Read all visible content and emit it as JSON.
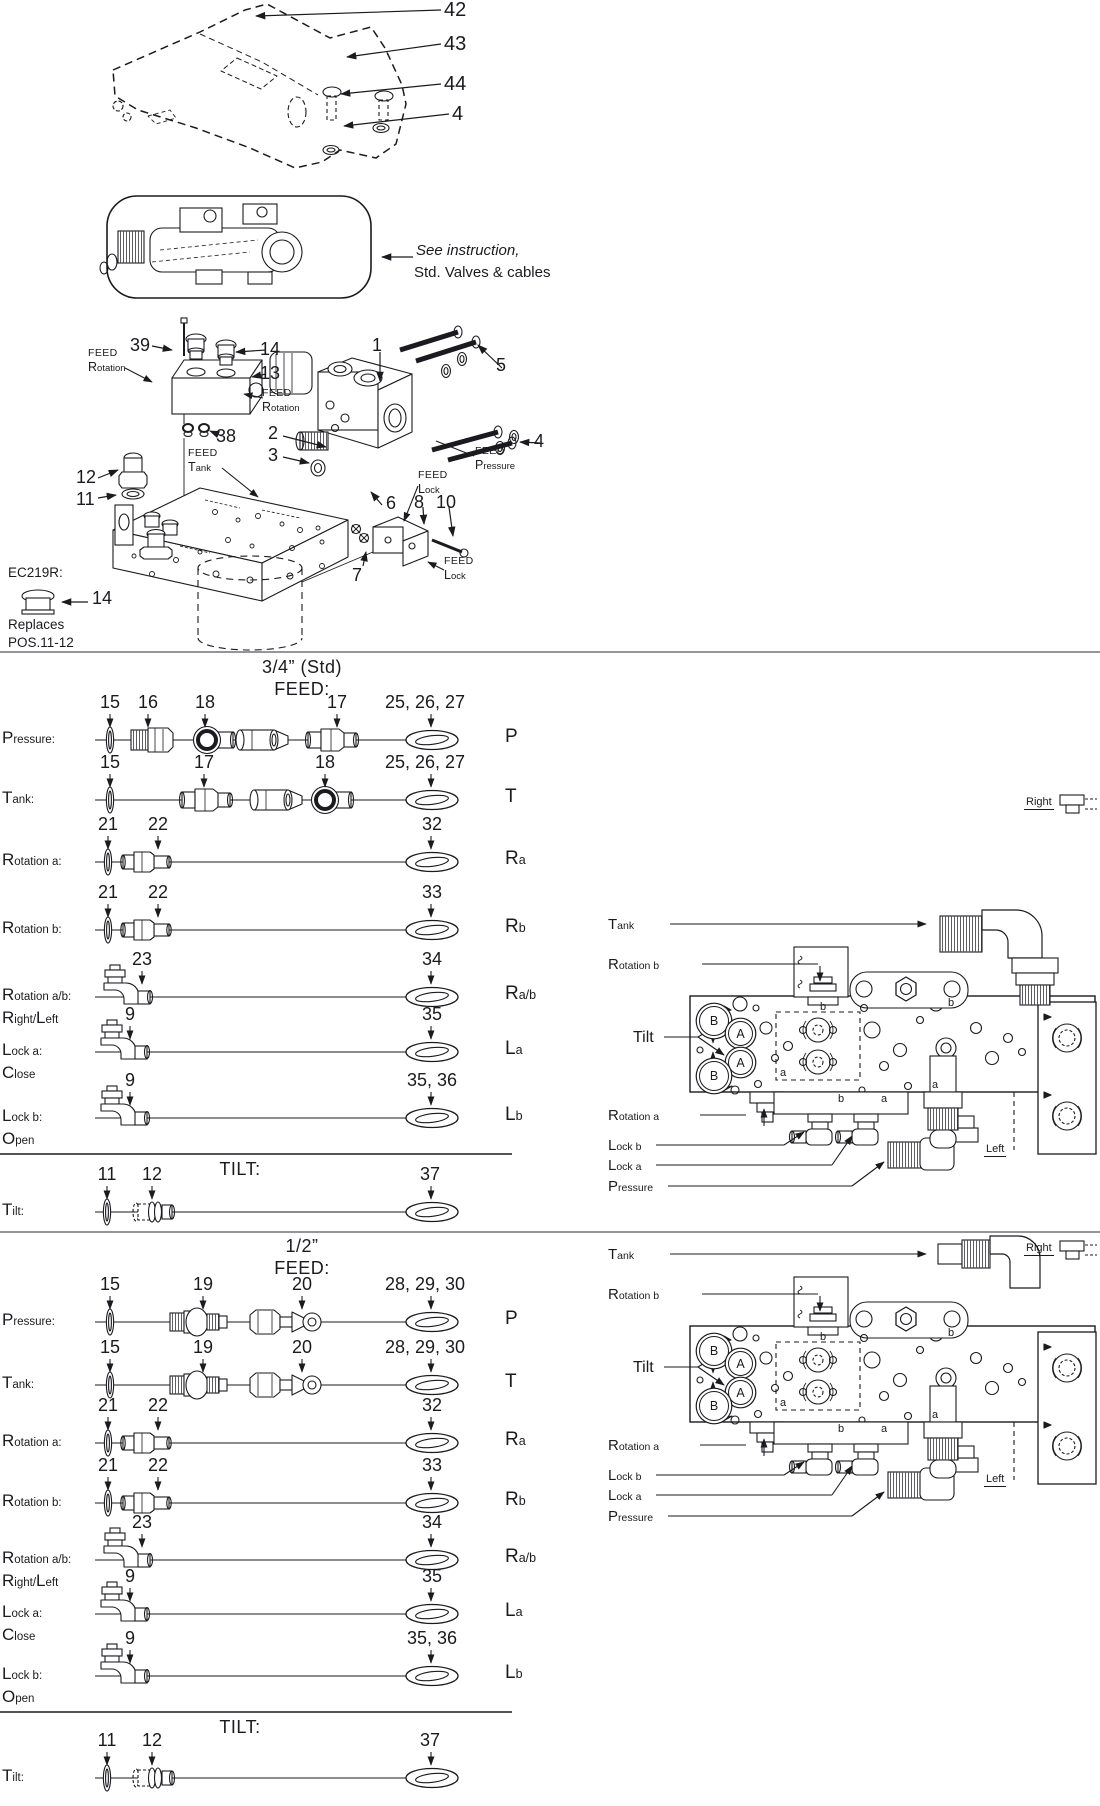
{
  "meta": {
    "ink": "#1b1b1f",
    "bg": "#ffffff",
    "divider": "#94949b"
  },
  "top_cover": {
    "callouts": [
      "42",
      "43",
      "44",
      "4"
    ]
  },
  "instruction": {
    "line1": "See instruction,",
    "line2": "Std. Valves & cables"
  },
  "exploded": {
    "callouts": [
      "39",
      "14",
      "13",
      "38",
      "1",
      "2",
      "3",
      "12",
      "11",
      "5",
      "4",
      "6",
      "8",
      "10",
      "7"
    ],
    "feed_labels": [
      {
        "t": "FEED",
        "b": "R",
        "s": "otation"
      },
      {
        "t": "FEED",
        "b": "R",
        "s": "otation"
      },
      {
        "t": "FEED",
        "b": "T",
        "s": "ank"
      },
      {
        "t": "FEED",
        "b": "P",
        "s": "ressure"
      },
      {
        "t": "FEED",
        "b": "L",
        "s": "ock"
      },
      {
        "t": "FEED",
        "b": "L",
        "s": "ock"
      }
    ],
    "ec_note": {
      "code": "EC219R:",
      "callout": "14",
      "line1": "Replaces",
      "line2": "POS.11-12"
    }
  },
  "sections": [
    {
      "size_header": "3/4” (Std)",
      "feed_header": "FEED:",
      "tilt_header": "TILT:",
      "rows": [
        {
          "label": {
            "b": "P",
            "s": "ressure:"
          },
          "callouts": [
            "15",
            "16",
            "18",
            "17",
            "25, 26, 27"
          ],
          "letter": {
            "b": "P",
            "s": ""
          }
        },
        {
          "label": {
            "b": "T",
            "s": "ank:"
          },
          "callouts": [
            "15",
            "17",
            "18",
            "25, 26, 27"
          ],
          "letter": {
            "b": "T",
            "s": ""
          }
        },
        {
          "label": {
            "b": "R",
            "s": "otation a:"
          },
          "callouts": [
            "21",
            "22",
            "32"
          ],
          "letter": {
            "b": "R",
            "s": "a"
          }
        },
        {
          "label": {
            "b": "R",
            "s": "otation b:"
          },
          "callouts": [
            "21",
            "22",
            "33"
          ],
          "letter": {
            "b": "R",
            "s": "b"
          }
        },
        {
          "label": {
            "b": "R",
            "s": "otation a/b:"
          },
          "sub": [
            {
              "b": "R",
              "s": "ight/"
            },
            {
              "b": "L",
              "s": "eft"
            }
          ],
          "callouts": [
            "23",
            "34"
          ],
          "letter": {
            "b": "R",
            "s": "a/b"
          }
        },
        {
          "label": {
            "b": "L",
            "s": "ock a:"
          },
          "sub": [
            {
              "b": "C",
              "s": "lose"
            }
          ],
          "callouts": [
            "9",
            "35"
          ],
          "letter": {
            "b": "L",
            "s": "a"
          }
        },
        {
          "label": {
            "b": "L",
            "s": "ock b:"
          },
          "sub": [
            {
              "b": "O",
              "s": "pen"
            }
          ],
          "callouts": [
            "9",
            "35, 36"
          ],
          "letter": {
            "b": "L",
            "s": "b"
          }
        }
      ],
      "tilt_row": {
        "label": {
          "b": "T",
          "s": "ilt:"
        },
        "callouts": [
          "11",
          "12",
          "37"
        ]
      },
      "diagram": {
        "tank": {
          "b": "T",
          "s": "ank"
        },
        "rotation_b": {
          "b": "R",
          "s": "otation b"
        },
        "tilt": "Tilt",
        "rotation_a": {
          "b": "R",
          "s": "otation a"
        },
        "lock_b": {
          "b": "L",
          "s": "ock b"
        },
        "lock_a": {
          "b": "L",
          "s": "ock a"
        },
        "pressure": {
          "b": "P",
          "s": "ressure"
        },
        "right": "Right",
        "left": "Left",
        "circles": [
          "B",
          "A",
          "A",
          "B"
        ],
        "ports": [
          "b",
          "a",
          "b",
          "b",
          "a",
          "a"
        ]
      }
    },
    {
      "size_header": "1/2”",
      "feed_header": "FEED:",
      "tilt_header": "TILT:",
      "rows": [
        {
          "label": {
            "b": "P",
            "s": "ressure:"
          },
          "callouts": [
            "15",
            "19",
            "20",
            "28, 29, 30"
          ],
          "letter": {
            "b": "P",
            "s": ""
          }
        },
        {
          "label": {
            "b": "T",
            "s": "ank:"
          },
          "callouts": [
            "15",
            "19",
            "20",
            "28, 29, 30"
          ],
          "letter": {
            "b": "T",
            "s": ""
          }
        },
        {
          "label": {
            "b": "R",
            "s": "otation a:"
          },
          "callouts": [
            "21",
            "22",
            "32"
          ],
          "letter": {
            "b": "R",
            "s": "a"
          }
        },
        {
          "label": {
            "b": "R",
            "s": "otation b:"
          },
          "callouts": [
            "21",
            "22",
            "33"
          ],
          "letter": {
            "b": "R",
            "s": "b"
          }
        },
        {
          "label": {
            "b": "R",
            "s": "otation a/b:"
          },
          "sub": [
            {
              "b": "R",
              "s": "ight/"
            },
            {
              "b": "L",
              "s": "eft"
            }
          ],
          "callouts": [
            "23",
            "34"
          ],
          "letter": {
            "b": "R",
            "s": "a/b"
          }
        },
        {
          "label": {
            "b": "L",
            "s": "ock a:"
          },
          "sub": [
            {
              "b": "C",
              "s": "lose"
            }
          ],
          "callouts": [
            "9",
            "35"
          ],
          "letter": {
            "b": "L",
            "s": "a"
          }
        },
        {
          "label": {
            "b": "L",
            "s": "ock b:"
          },
          "sub": [
            {
              "b": "O",
              "s": "pen"
            }
          ],
          "callouts": [
            "9",
            "35, 36"
          ],
          "letter": {
            "b": "L",
            "s": "b"
          }
        }
      ],
      "tilt_row": {
        "label": {
          "b": "T",
          "s": "ilt:"
        },
        "callouts": [
          "11",
          "12",
          "37"
        ]
      },
      "diagram": {
        "tank": {
          "b": "T",
          "s": "ank"
        },
        "rotation_b": {
          "b": "R",
          "s": "otation b"
        },
        "tilt": "Tilt",
        "rotation_a": {
          "b": "R",
          "s": "otation a"
        },
        "lock_b": {
          "b": "L",
          "s": "ock b"
        },
        "lock_a": {
          "b": "L",
          "s": "ock a"
        },
        "pressure": {
          "b": "P",
          "s": "ressure"
        },
        "right": "Right",
        "left": "Left",
        "circles": [
          "B",
          "A",
          "A",
          "B"
        ],
        "ports": [
          "b",
          "a",
          "b",
          "b",
          "a",
          "a"
        ]
      }
    }
  ]
}
